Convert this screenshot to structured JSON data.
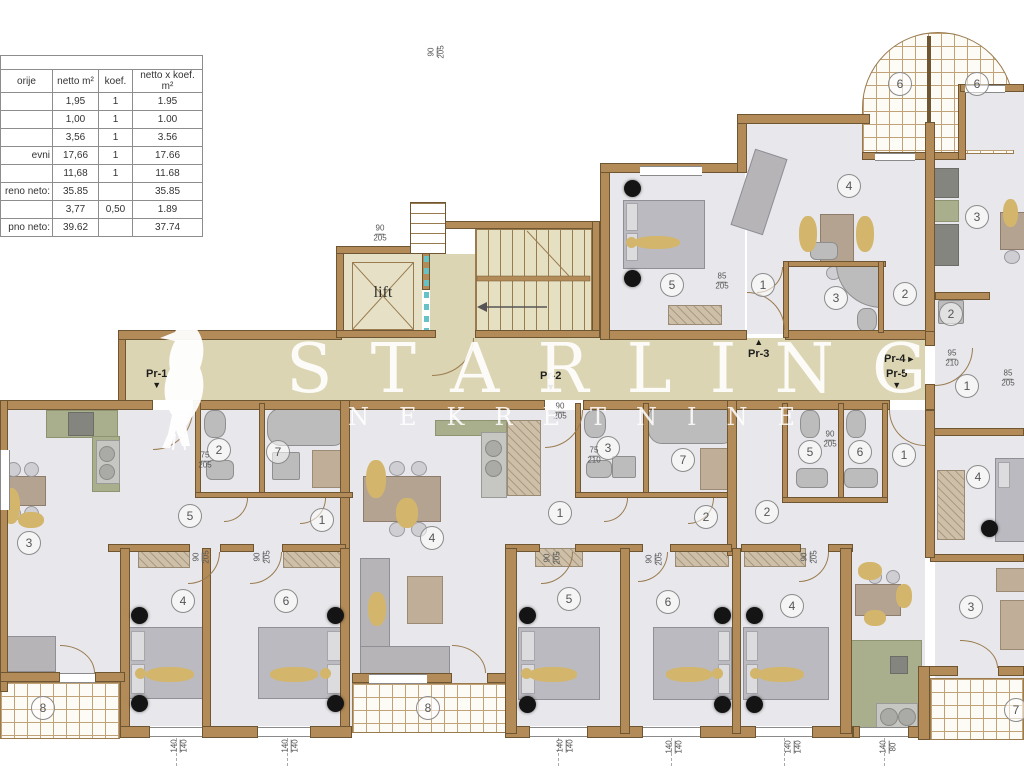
{
  "area_table": {
    "headers": [
      "orije",
      "netto m²",
      "koef.",
      "netto x koef. m²"
    ],
    "rows": [
      [
        "",
        "1,95",
        "1",
        "1.95"
      ],
      [
        "",
        "1,00",
        "1",
        "1.00"
      ],
      [
        "",
        "3,56",
        "1",
        "3.56"
      ],
      [
        "evni",
        "17,66",
        "1",
        "17.66"
      ],
      [
        "",
        "11,68",
        "1",
        "11.68"
      ],
      [
        "reno neto:",
        "35.85",
        "",
        "35.85"
      ],
      [
        "",
        "3,77",
        "0,50",
        "1.89"
      ],
      [
        "pno neto:",
        "39.62",
        "",
        "37.74"
      ]
    ]
  },
  "core": {
    "lift_label": "lift"
  },
  "watermark": {
    "brand": "STARLING",
    "subtitle": "NEKRETNINE",
    "logo": "starling-bird"
  },
  "icons": {
    "arrow-down": "▼",
    "arrow-up": "▲",
    "arrow-right": "►"
  },
  "entrances": [
    {
      "label": "Pr-1",
      "dir": "down",
      "x": 146,
      "y": 368
    },
    {
      "label": "Pr-2",
      "dir": "down",
      "x": 540,
      "y": 370
    },
    {
      "label": "Pr-3",
      "dir": "up",
      "x": 748,
      "y": 338
    },
    {
      "label": "Pr-4",
      "dir": "right",
      "x": 884,
      "y": 353
    },
    {
      "label": "Pr-5",
      "dir": "down",
      "x": 886,
      "y": 368
    }
  ],
  "room_numbers": [
    {
      "n": "6",
      "x": 900,
      "y": 84
    },
    {
      "n": "6",
      "x": 977,
      "y": 84
    },
    {
      "n": "5",
      "x": 672,
      "y": 285
    },
    {
      "n": "4",
      "x": 849,
      "y": 186
    },
    {
      "n": "1",
      "x": 763,
      "y": 285
    },
    {
      "n": "3",
      "x": 836,
      "y": 298
    },
    {
      "n": "2",
      "x": 905,
      "y": 294
    },
    {
      "n": "3",
      "x": 977,
      "y": 217
    },
    {
      "n": "2",
      "x": 951,
      "y": 314
    },
    {
      "n": "1",
      "x": 967,
      "y": 386
    },
    {
      "n": "3",
      "x": 29,
      "y": 543
    },
    {
      "n": "5",
      "x": 190,
      "y": 516
    },
    {
      "n": "1",
      "x": 322,
      "y": 520
    },
    {
      "n": "2",
      "x": 219,
      "y": 450
    },
    {
      "n": "7",
      "x": 278,
      "y": 452
    },
    {
      "n": "4",
      "x": 432,
      "y": 538
    },
    {
      "n": "1",
      "x": 560,
      "y": 513
    },
    {
      "n": "3",
      "x": 608,
      "y": 448
    },
    {
      "n": "7",
      "x": 683,
      "y": 460
    },
    {
      "n": "2",
      "x": 706,
      "y": 517
    },
    {
      "n": "2",
      "x": 767,
      "y": 512
    },
    {
      "n": "5",
      "x": 810,
      "y": 452
    },
    {
      "n": "6",
      "x": 860,
      "y": 452
    },
    {
      "n": "1",
      "x": 904,
      "y": 455
    },
    {
      "n": "4",
      "x": 978,
      "y": 477
    },
    {
      "n": "4",
      "x": 183,
      "y": 601
    },
    {
      "n": "6",
      "x": 286,
      "y": 601
    },
    {
      "n": "5",
      "x": 569,
      "y": 599
    },
    {
      "n": "6",
      "x": 668,
      "y": 602
    },
    {
      "n": "4",
      "x": 792,
      "y": 606
    },
    {
      "n": "8",
      "x": 43,
      "y": 708
    },
    {
      "n": "8",
      "x": 428,
      "y": 708
    },
    {
      "n": "3",
      "x": 971,
      "y": 607
    },
    {
      "n": "7",
      "x": 1016,
      "y": 710
    }
  ],
  "dimensions": [
    {
      "t": "140/140",
      "x": 180,
      "y": 746,
      "r": -90
    },
    {
      "t": "140/140",
      "x": 291,
      "y": 746,
      "r": -90
    },
    {
      "t": "140/140",
      "x": 566,
      "y": 746,
      "r": -90
    },
    {
      "t": "140/140",
      "x": 675,
      "y": 747,
      "r": -90
    },
    {
      "t": "140/140",
      "x": 794,
      "y": 747,
      "r": -90
    },
    {
      "t": "140/80",
      "x": 889,
      "y": 747,
      "r": -90
    },
    {
      "t": "95/210",
      "x": 952,
      "y": 359,
      "r": 0
    },
    {
      "t": "85/205",
      "x": 1008,
      "y": 379,
      "r": 0
    },
    {
      "t": "85/205",
      "x": 722,
      "y": 282,
      "r": 0
    },
    {
      "t": "90/205",
      "x": 560,
      "y": 412,
      "r": 0
    },
    {
      "t": "75/210",
      "x": 594,
      "y": 456,
      "r": 0
    },
    {
      "t": "75/205",
      "x": 205,
      "y": 461,
      "r": 0
    },
    {
      "t": "90/205",
      "x": 830,
      "y": 440,
      "r": 0
    },
    {
      "t": "90/205",
      "x": 202,
      "y": 557,
      "r": -90
    },
    {
      "t": "90/205",
      "x": 263,
      "y": 557,
      "r": -90
    },
    {
      "t": "90/205",
      "x": 553,
      "y": 558,
      "r": -90
    },
    {
      "t": "90/205",
      "x": 655,
      "y": 559,
      "r": -90
    },
    {
      "t": "90/205",
      "x": 810,
      "y": 557,
      "r": -90
    },
    {
      "t": "90/205",
      "x": 380,
      "y": 234,
      "r": 0
    },
    {
      "t": "90/205",
      "x": 437,
      "y": 52,
      "r": -90
    }
  ],
  "lamp_dots": [
    {
      "x": 139,
      "y": 615
    },
    {
      "x": 139,
      "y": 703
    },
    {
      "x": 335,
      "y": 615
    },
    {
      "x": 335,
      "y": 703
    },
    {
      "x": 527,
      "y": 615
    },
    {
      "x": 527,
      "y": 704
    },
    {
      "x": 722,
      "y": 615
    },
    {
      "x": 722,
      "y": 704
    },
    {
      "x": 754,
      "y": 615
    },
    {
      "x": 754,
      "y": 704
    },
    {
      "x": 632,
      "y": 188
    },
    {
      "x": 632,
      "y": 278
    },
    {
      "x": 989,
      "y": 528
    }
  ],
  "colors": {
    "wall": "#b38b59",
    "wall_edge": "#6f5633",
    "corridor": "#dbd5b3",
    "room_floor": "#e8e8ec",
    "balcony_grid": "#c0a276",
    "kitchen": "#a9ae8c",
    "figure_gold": "#d3b66c",
    "watermark": "#ffffff"
  }
}
